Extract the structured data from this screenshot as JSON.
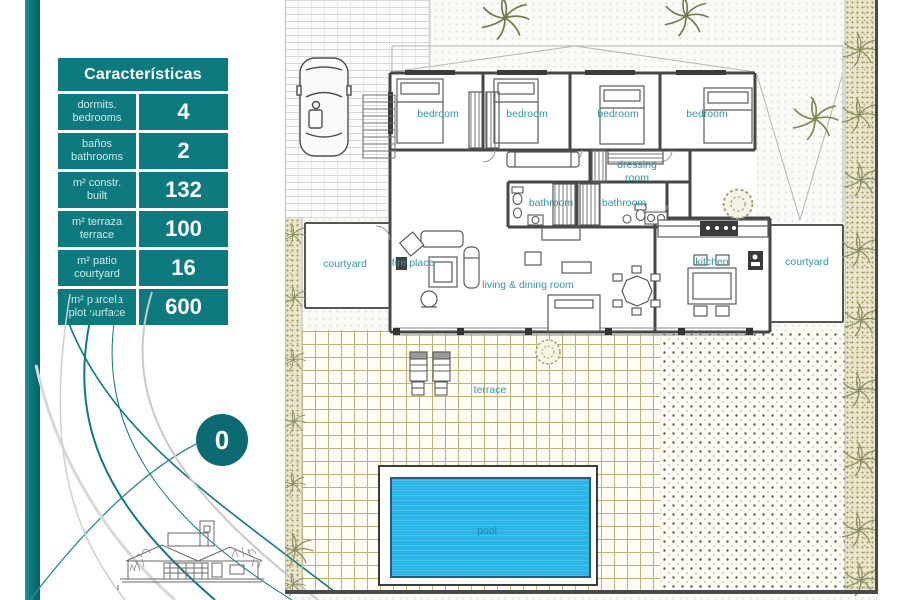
{
  "brand": {
    "accent_teal": "#0d7a80",
    "badge_teal": "#0b6b72",
    "plan_label_teal": "#2f98a6",
    "pool_blue": "#29b5e6",
    "tile_line_tan": "#c2b176"
  },
  "table": {
    "title": "Características",
    "rows": [
      {
        "label_line1": "dormits.",
        "label_line2": "bedrooms",
        "value": "4"
      },
      {
        "label_line1": "baños",
        "label_line2": "bathrooms",
        "value": "2"
      },
      {
        "label_line1": "m² constr.",
        "label_line2": "built",
        "value": "132"
      },
      {
        "label_line1": "m² terraza",
        "label_line2": "terrace",
        "value": "100"
      },
      {
        "label_line1": "m² patio",
        "label_line2": "courtyard",
        "value": "16"
      },
      {
        "label_line1": "m² parcela",
        "label_line2": "plot surface",
        "value": "600"
      }
    ]
  },
  "level_badge": {
    "value": "0"
  },
  "plan": {
    "labels": {
      "bedroom": "bedroom",
      "dressing_room": "dressing room",
      "bathroom": "bathroom",
      "courtyard": "courtyard",
      "fire_place": "fire place",
      "living_dining": "living & dining room",
      "kitchen": "kitchen",
      "terrace": "terrace",
      "pool": "pool"
    }
  }
}
